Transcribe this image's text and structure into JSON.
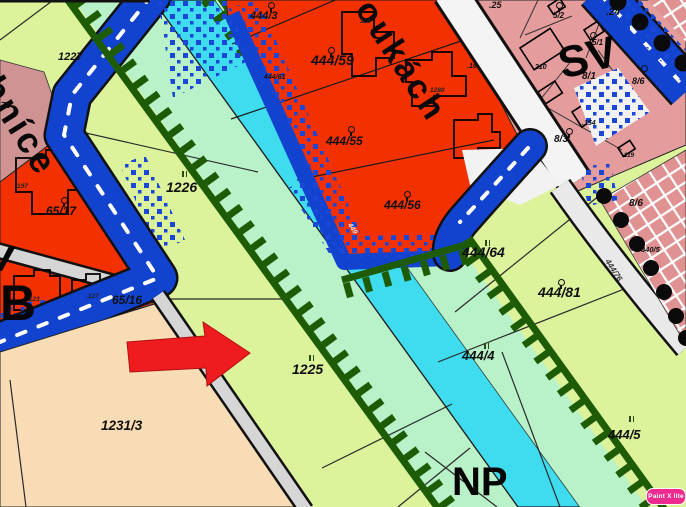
{
  "map": {
    "street_labels": {
      "left_road": "bníce",
      "top_road": "oukách"
    },
    "zone_labels": {
      "sv": "SV",
      "np": "NP",
      "b": "B",
      "v": "v"
    },
    "parcel_labels": {
      "p1227": "1227",
      "p1226": "1226",
      "p1225": "1225",
      "p1231_3": "1231/3",
      "p65_17": "65/17",
      "p65_16": "65/16",
      "p71": "71",
      "p444_3": "444/3",
      "p444_59": "444/59",
      "p444_61": "444/61",
      "p444_55": "444/55",
      "p444_56": "444/56",
      "p444_64": "444/64",
      "p444_81": "444/81",
      "p444_4": "444/4",
      "p444_5": "444/5",
      "p444_76": "444/76",
      "p449": "449",
      "p5_1": "5/1",
      "p5_2": "5/2",
      "p25": ".25",
      "p24": ".24",
      "p210": ".210",
      "p16": ".16",
      "p8_1": "8/1",
      "p8_3": "8/3",
      "p8_6a": "8/6",
      "p8_6b": "8/6",
      "p154": ".154",
      "p119": ".119",
      "p840_5": "840/5"
    },
    "building_labels": {
      "b197": "197",
      "b123": ".123",
      "b127": ".127",
      "b118": "118",
      "b1280": "1280"
    },
    "symbols": {
      "orchard": "circle-with-stem",
      "meadow": "double-tick"
    },
    "watermark": {
      "label": "Paint X lite"
    },
    "colors": {
      "parcel_green": "#dcf29b",
      "corridor_mint": "#b9f2c8",
      "stream_cyan": "#3fdcef",
      "hatch_dark_green": "#1d5c05",
      "residential_red": "#f23000",
      "mixed_pink": "#e59c9c",
      "mauve": "#cf9393",
      "peach": "#f8dcb6",
      "road_blue": "#1243cf",
      "road_gray": "#d6d6d6",
      "road_white": "#f4f4f4",
      "arrow_red": "#ee1c1f",
      "watermark_pink": "#ef2a8e"
    }
  }
}
